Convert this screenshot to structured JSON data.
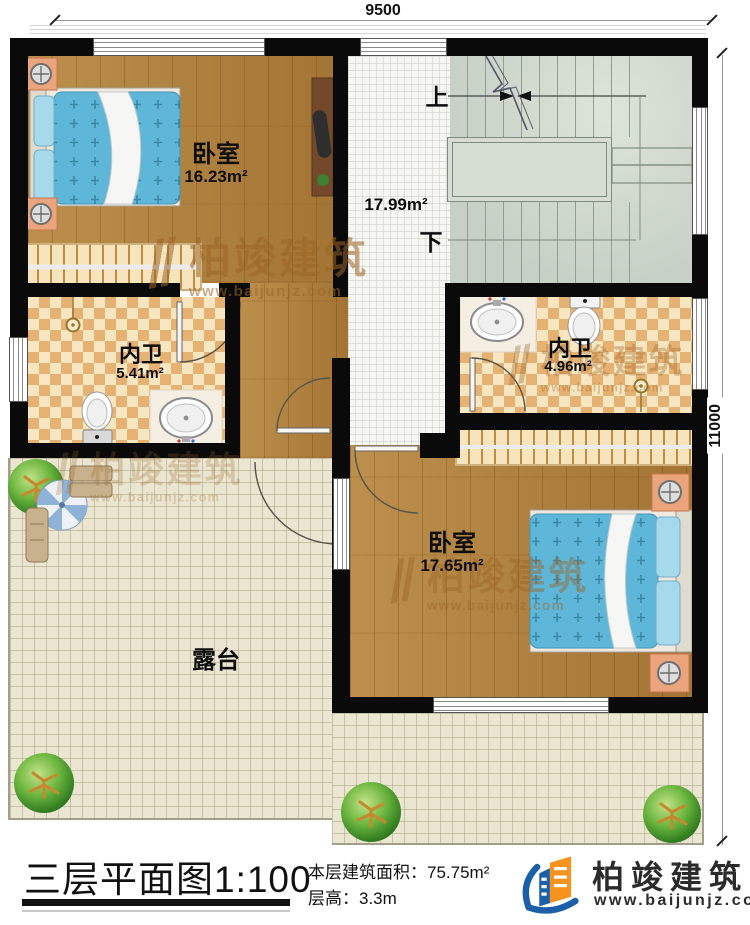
{
  "dimensions": {
    "top": "9500",
    "right": "11000"
  },
  "rooms": {
    "bedroom1": {
      "name": "卧室",
      "area": "16.23m²"
    },
    "hall": {
      "area": "17.99m²",
      "up": "上",
      "down": "下"
    },
    "bath1": {
      "name": "内卫",
      "area": "5.41m²"
    },
    "bath2": {
      "name": "内卫",
      "area": "4.96m²"
    },
    "bedroom2": {
      "name": "卧室",
      "area": "17.65m²"
    },
    "terrace": {
      "name": "露台"
    }
  },
  "watermark": {
    "brand": "柏竣建筑",
    "url": "www.baijunjz.com"
  },
  "title_block": {
    "plan_title": "三层平面图",
    "scale": "1:100",
    "floor_area_label": "本层建筑面积：",
    "floor_area_value": "75.75m²",
    "floor_height_label": "层高：",
    "floor_height_value": "3.3m",
    "brand": "柏竣建筑",
    "website": "www.baijunjz.com"
  },
  "colors": {
    "wall": "#0a0a0a",
    "wood_floor": "#b0803c",
    "bath_tile": "#e5b273",
    "stair_floor": "#ccd5cb",
    "terrace_floor": "#ebe6d1",
    "bed_blanket": "#5eb7d9",
    "watermark": "#9c6526",
    "logo_blue": "#1a5fa8",
    "logo_orange": "#f6921e"
  }
}
